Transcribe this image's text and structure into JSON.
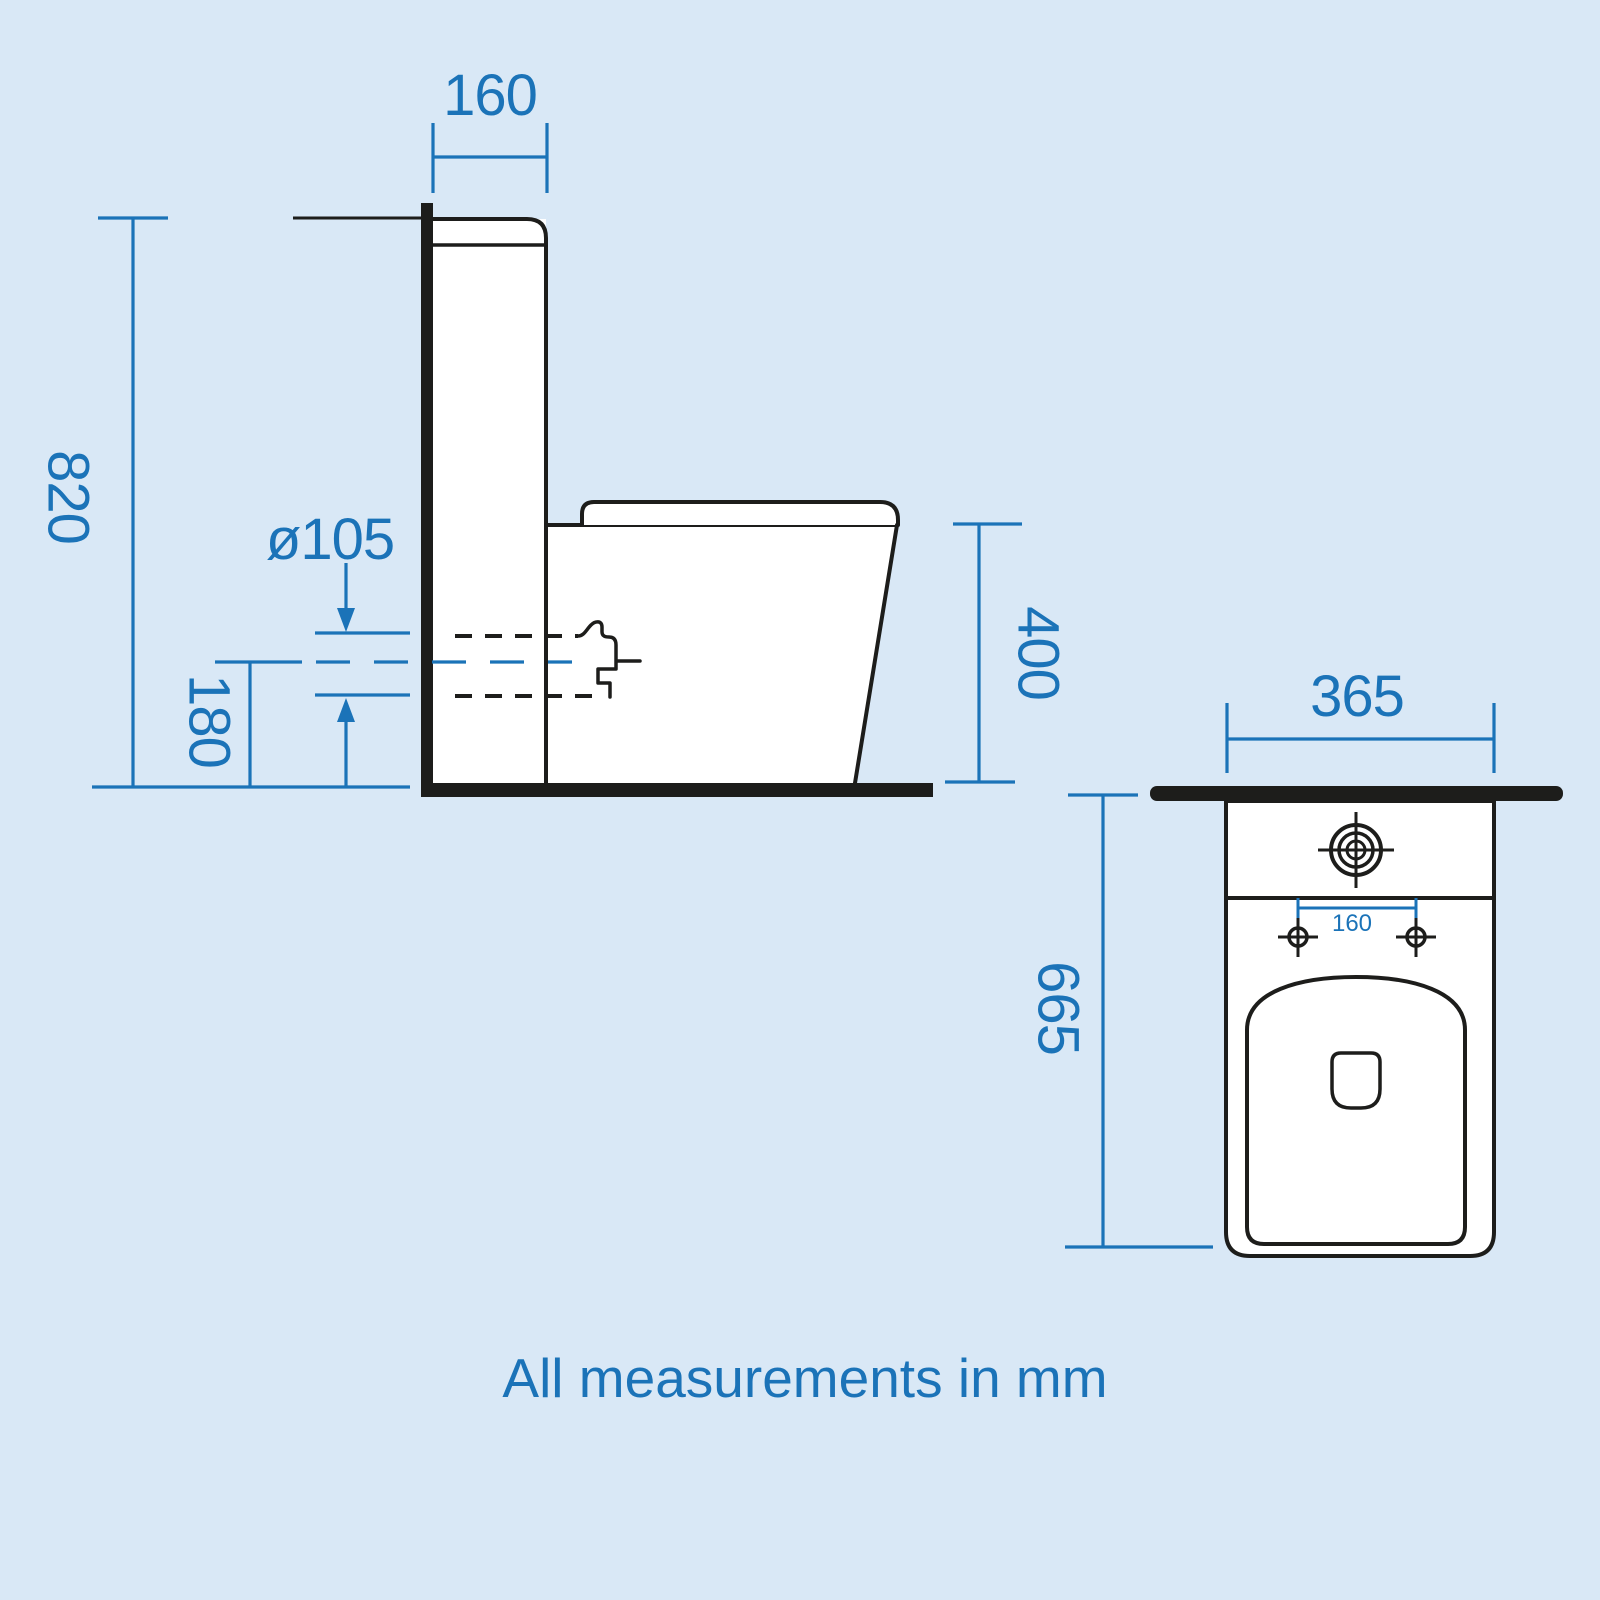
{
  "drawing": {
    "note": "All measurements in mm",
    "colors": {
      "dimension_blue": "#1b73b8",
      "outline_black": "#1d1d1b",
      "background_blue": "#d9e8f6",
      "surface_white": "#ffffff"
    },
    "side_view": {
      "dimensions": {
        "cistern_depth": "160",
        "overall_height": "820",
        "outlet_diameter": "ø105",
        "outlet_centre_height": "180",
        "pan_height": "400"
      }
    },
    "top_view": {
      "dimensions": {
        "overall_width": "365",
        "overall_depth": "665",
        "fixing_hole_centres": "160"
      }
    }
  }
}
